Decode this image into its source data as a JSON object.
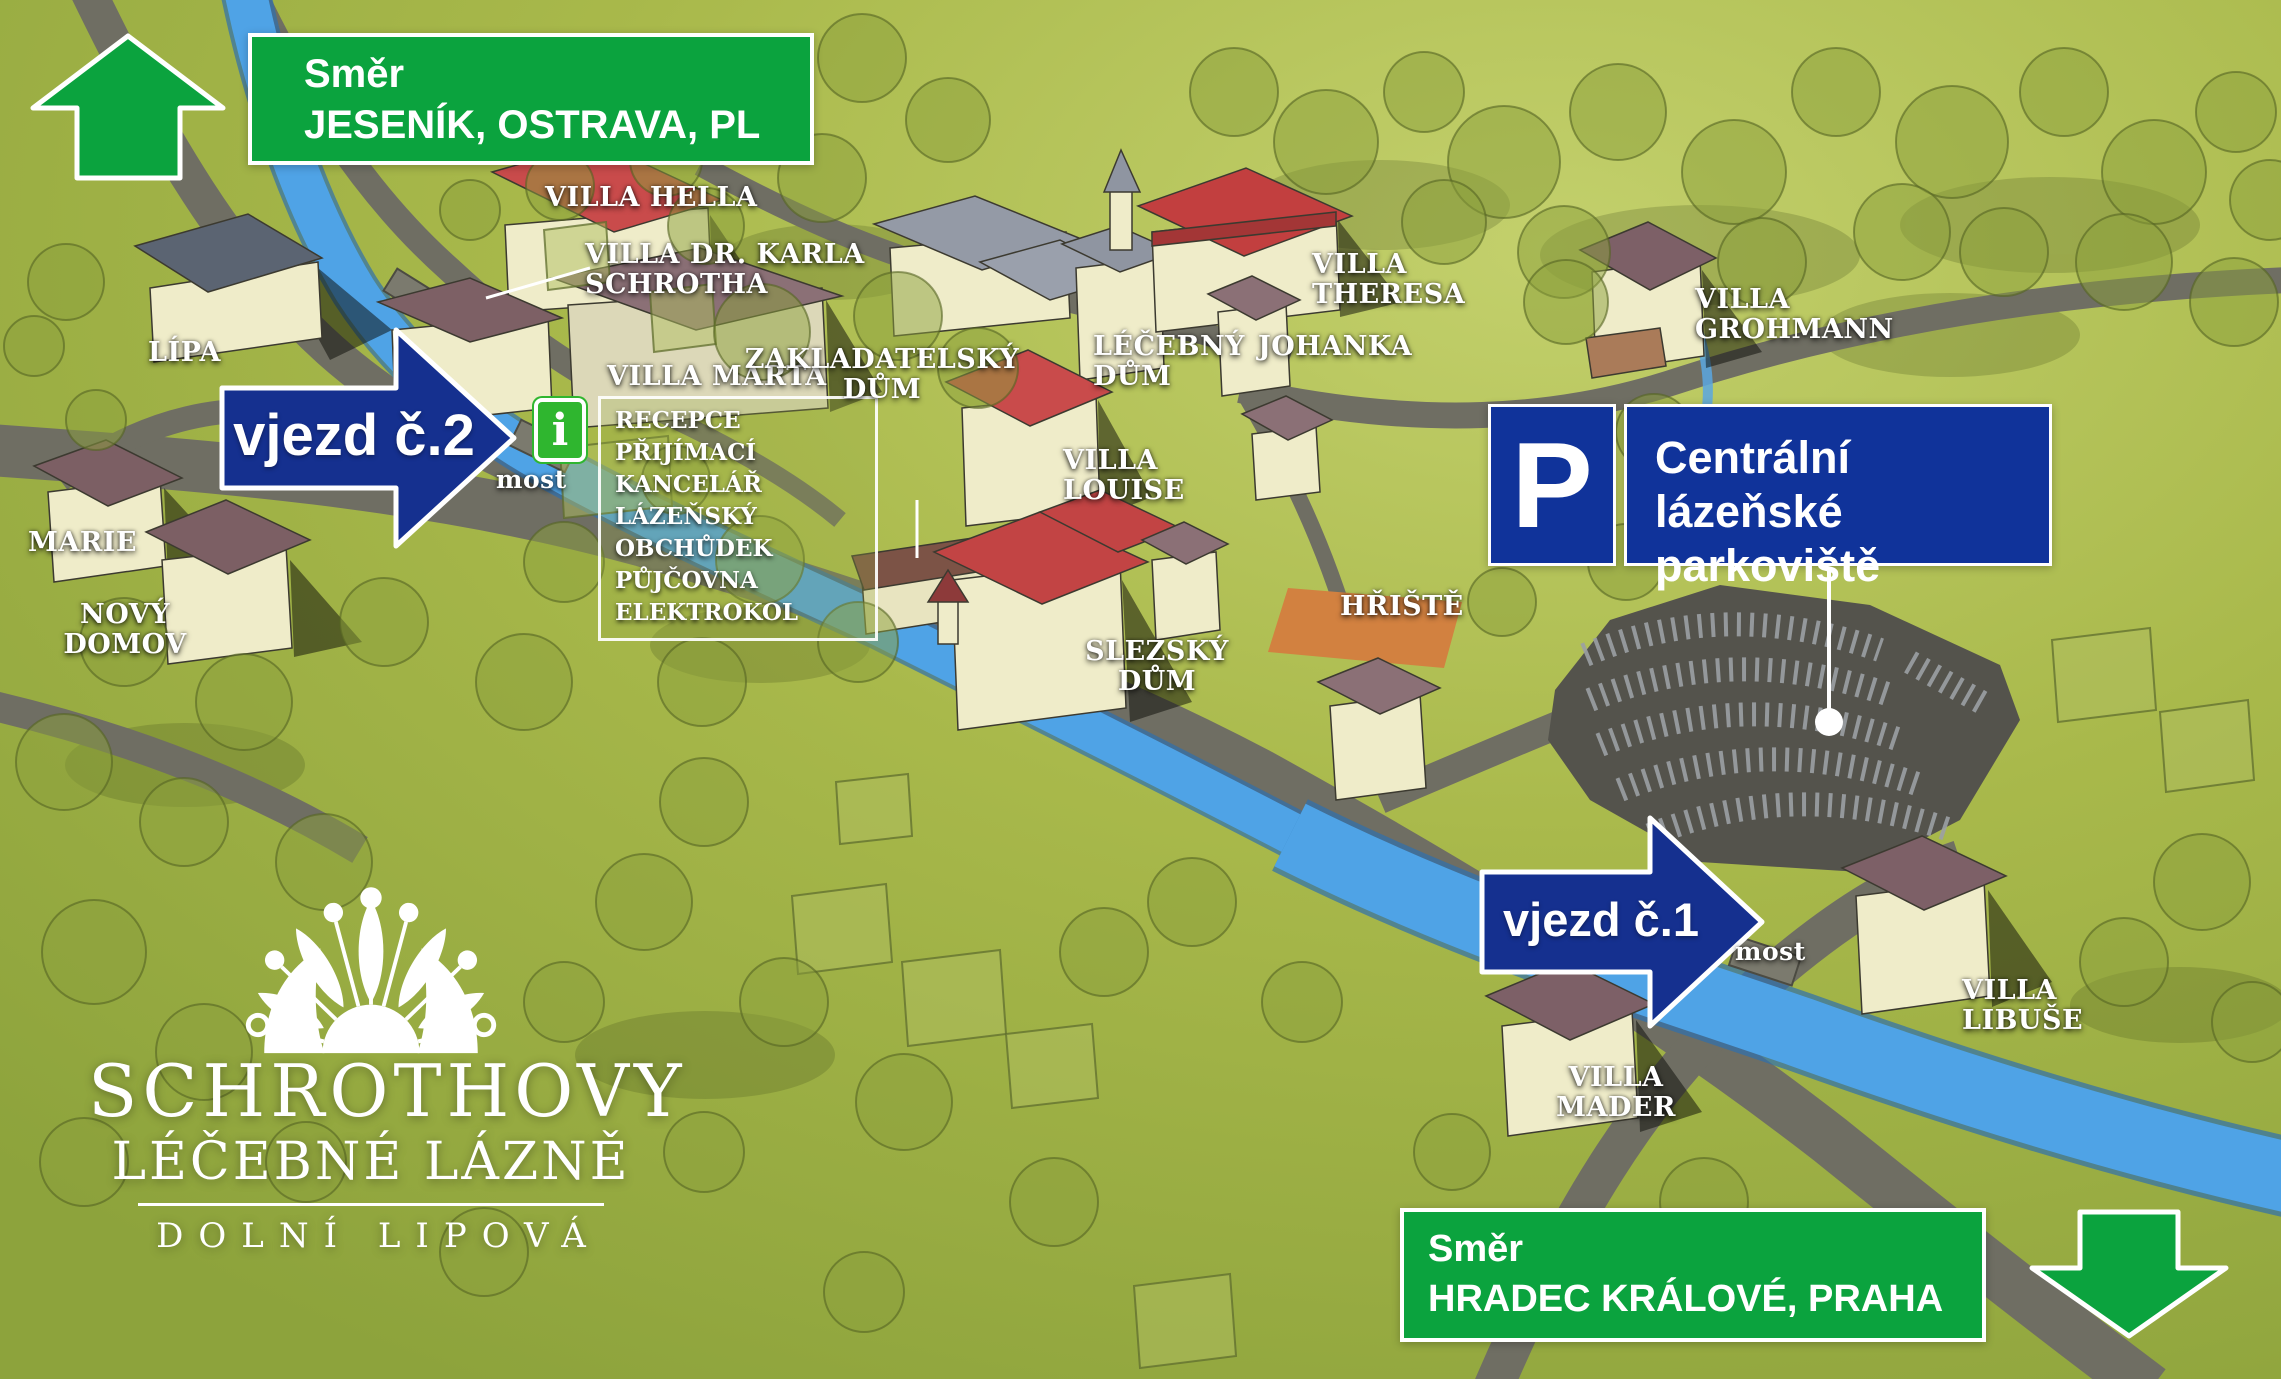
{
  "signs": {
    "top": {
      "smer": "Směr",
      "dest": "JESENÍK, OSTRAVA, PL"
    },
    "bottom": {
      "smer": "Směr",
      "dest": "HRADEC KRÁLOVÉ, PRAHA"
    },
    "entrance2": "vjezd č.2",
    "entrance1": "vjezd č.1",
    "parking": {
      "symbol": "P",
      "line1": "Centrální",
      "line2": "lázeňské parkoviště"
    },
    "info_symbol": "i"
  },
  "info_box": {
    "lines": [
      "RECEPCE",
      "PŘIJÍMACÍ KANCELÁŘ",
      "LÁZEŇSKÝ OBCHŮDEK",
      "PŮJČOVNA ELEKTROKOL"
    ]
  },
  "labels": {
    "lipa": "LÍPA",
    "marie": "MARIE",
    "novy_domov": {
      "l1": "NOVÝ",
      "l2": "DOMOV"
    },
    "villa_hella": "VILLA HELLA",
    "villa_dr_karla": {
      "l1": "VILLA DR. KARLA",
      "l2": "SCHROTHA"
    },
    "villa_marta": "VILLA MARTA",
    "most_bridge2": "most",
    "most_bridge1": "most",
    "zakladatelsky": {
      "l1": "ZAKLADATELSKÝ",
      "l2": "DŮM"
    },
    "lecebny": {
      "l1": "LÉČEBNÝ",
      "l2": "DŮM"
    },
    "johanka": "JOHANKA",
    "villa_theresa": {
      "l1": "VILLA",
      "l2": "THERESA"
    },
    "villa_grohmann": {
      "l1": "VILLA",
      "l2": "GROHMANN"
    },
    "villa_louise": {
      "l1": "VILLA",
      "l2": "LOUISE"
    },
    "slezsky": {
      "l1": "SLEZSKÝ",
      "l2": "DŮM"
    },
    "hriste": "HŘIŠTĚ",
    "villa_mader": {
      "l1": "VILLA",
      "l2": "MADER"
    },
    "villa_libuse": {
      "l1": "VILLA",
      "l2": "LIBUŠE"
    }
  },
  "logo": {
    "line1": "SCHROTHOVY",
    "line2": "LÉČEBNÉ LÁZNĚ",
    "line3": "DOLNÍ LIPOVÁ"
  },
  "colors": {
    "sign_green": "#0ba33e",
    "arrow_blue": "#15308f",
    "parking_blue": "#10339a",
    "info_green": "#2fb62f",
    "river_blue": "#4fa3e6",
    "road_gray": "#6f6e63",
    "grass_green": "#a9b94b"
  }
}
